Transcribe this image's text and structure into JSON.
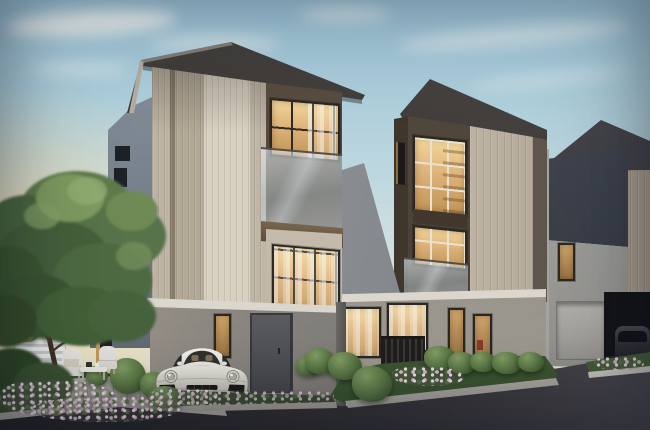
{
  "scene": {
    "description": "Dusk 3D architectural rendering of a row of modern three-storey terraced houses with dark hip roofs, warm-lit windows, glass balconies and landscaped front gardens; a white sports coupe is parked in the left carport and a dark SUV in the right carport beside a curving asphalt driveway",
    "time_of_day": "dusk",
    "houses": [
      {
        "id": "house-left",
        "storeys": 3,
        "features": [
          "hip roof",
          "vertical-slat feature column",
          "glass balcony",
          "carport with parked car",
          "grey entrance door"
        ]
      },
      {
        "id": "house-middle",
        "storeys": 3,
        "features": [
          "hip roof",
          "corner picture windows",
          "glass balcony",
          "vertical-slat panel",
          "slatted privacy fence"
        ]
      },
      {
        "id": "house-right",
        "storeys": 3,
        "features": [
          "hip roof",
          "garage door",
          "carport with parked SUV"
        ]
      }
    ],
    "vehicles": [
      {
        "id": "white-sports-car",
        "type": "sports coupe",
        "color_name": "white",
        "license_plate": "illegible dark text on light plate"
      },
      {
        "id": "dark-suv",
        "type": "SUV",
        "color_name": "dark grey"
      }
    ],
    "landscape": [
      "large frangipani-style tree",
      "pink and white flower beds with white curbs",
      "trimmed hedges and topiary bushes",
      "paved patio with two outdoor chairs and a low table",
      "white slatted privacy screen",
      "dark asphalt road"
    ]
  },
  "colors": {
    "sky_top": "#9cc4d8",
    "sky_mid": "#c9dde2",
    "sky_low": "#e9ebdf",
    "cloud": "#f6f8f5",
    "roof": "#45413d",
    "frame": "#2b2823",
    "beige_light": "#d8d0c1",
    "beige": "#c6bcac",
    "beige_dark": "#a99e8c",
    "brown_wall": "#54493d",
    "brown_band": "#6e5c49",
    "side_blue": "#7e8994",
    "gray_wall": "#8e8b84",
    "soffit": "#dbd7cf",
    "window_glow": "#ddb278",
    "window_glow_hi": "#f2d79c",
    "door": "#54565a",
    "road": "#302f33",
    "curb": "#d8d5ce",
    "green_dark": "#3c5430",
    "green": "#5d7a47",
    "green_hi": "#85a167",
    "flower_pink": "#d9bfca",
    "flower_white": "#efe9ea",
    "car_body": "#eae7e1",
    "suv_body": "#35363c"
  }
}
